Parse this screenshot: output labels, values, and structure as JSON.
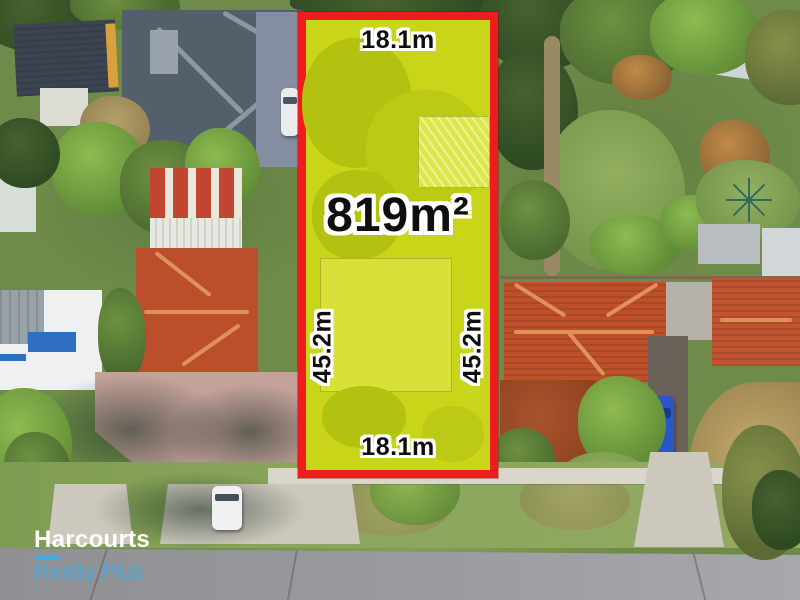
{
  "listing": {
    "area": "819m²",
    "width_top": "18.1m",
    "width_bottom": "18.1m",
    "depth_left": "45.2m",
    "depth_right": "45.2m"
  },
  "branding": {
    "agency": "Harcourts",
    "division": "Realty Plus"
  },
  "colors": {
    "boundary_red": "#ee1c1c",
    "lot_overlay": "#c9d518",
    "label_text": "#0e0e0e",
    "label_outline": "#ffffff",
    "brand_white": "#ffffff",
    "brand_cyan": "#45aadd"
  }
}
